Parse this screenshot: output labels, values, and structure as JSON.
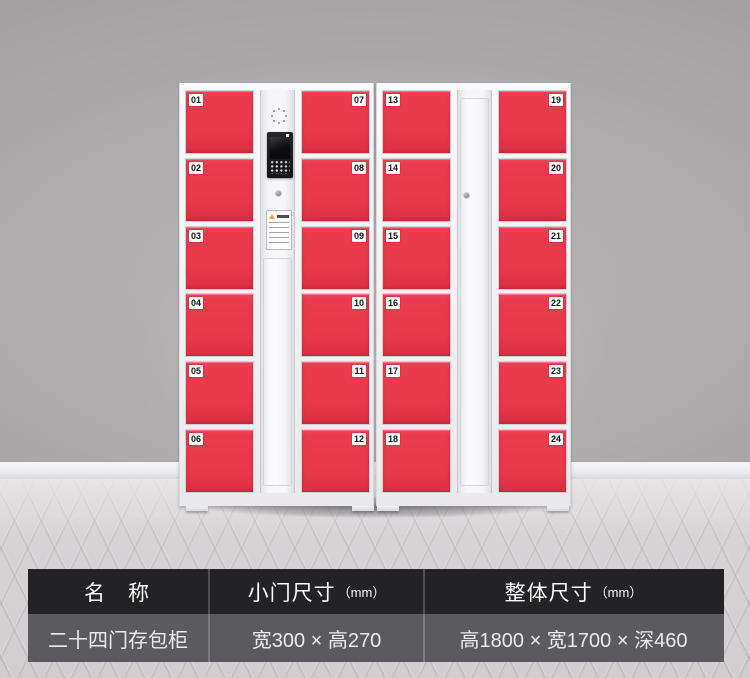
{
  "locker": {
    "cabinets": [
      {
        "name": "left-cabinet",
        "columns": [
          {
            "type": "doors",
            "label_side": "left",
            "numbers": [
              "01",
              "02",
              "03",
              "04",
              "05",
              "06"
            ]
          },
          {
            "type": "control-panel",
            "features": [
              "speaker-grille",
              "camera-screen",
              "keypad",
              "keyhole",
              "notice-card"
            ]
          },
          {
            "type": "doors",
            "label_side": "right",
            "numbers": [
              "07",
              "08",
              "09",
              "10",
              "11",
              "12"
            ]
          }
        ]
      },
      {
        "name": "right-cabinet",
        "columns": [
          {
            "type": "doors",
            "label_side": "left",
            "numbers": [
              "13",
              "14",
              "15",
              "16",
              "17",
              "18"
            ]
          },
          {
            "type": "blank-panel",
            "features": [
              "keyhole"
            ]
          },
          {
            "type": "doors",
            "label_side": "right",
            "numbers": [
              "19",
              "20",
              "21",
              "22",
              "23",
              "24"
            ]
          }
        ]
      }
    ]
  },
  "spec_table": {
    "columns": [
      {
        "header": "名　称",
        "unit": "",
        "value": "二十四门存包柜"
      },
      {
        "header": "小门尺寸",
        "unit": "（mm）",
        "value": "宽300 × 高270"
      },
      {
        "header": "整体尺寸",
        "unit": "（mm）",
        "value": "高1800 × 宽1700 × 深460"
      }
    ]
  },
  "colors": {
    "door_red": "#e9394e",
    "cabinet_white": "#f2f2f5",
    "wall_gray": "#a9a7a7",
    "floor_gray": "#d3d1d2",
    "table_header_bg": "#232325",
    "table_value_bg": "#5b5b5f"
  }
}
